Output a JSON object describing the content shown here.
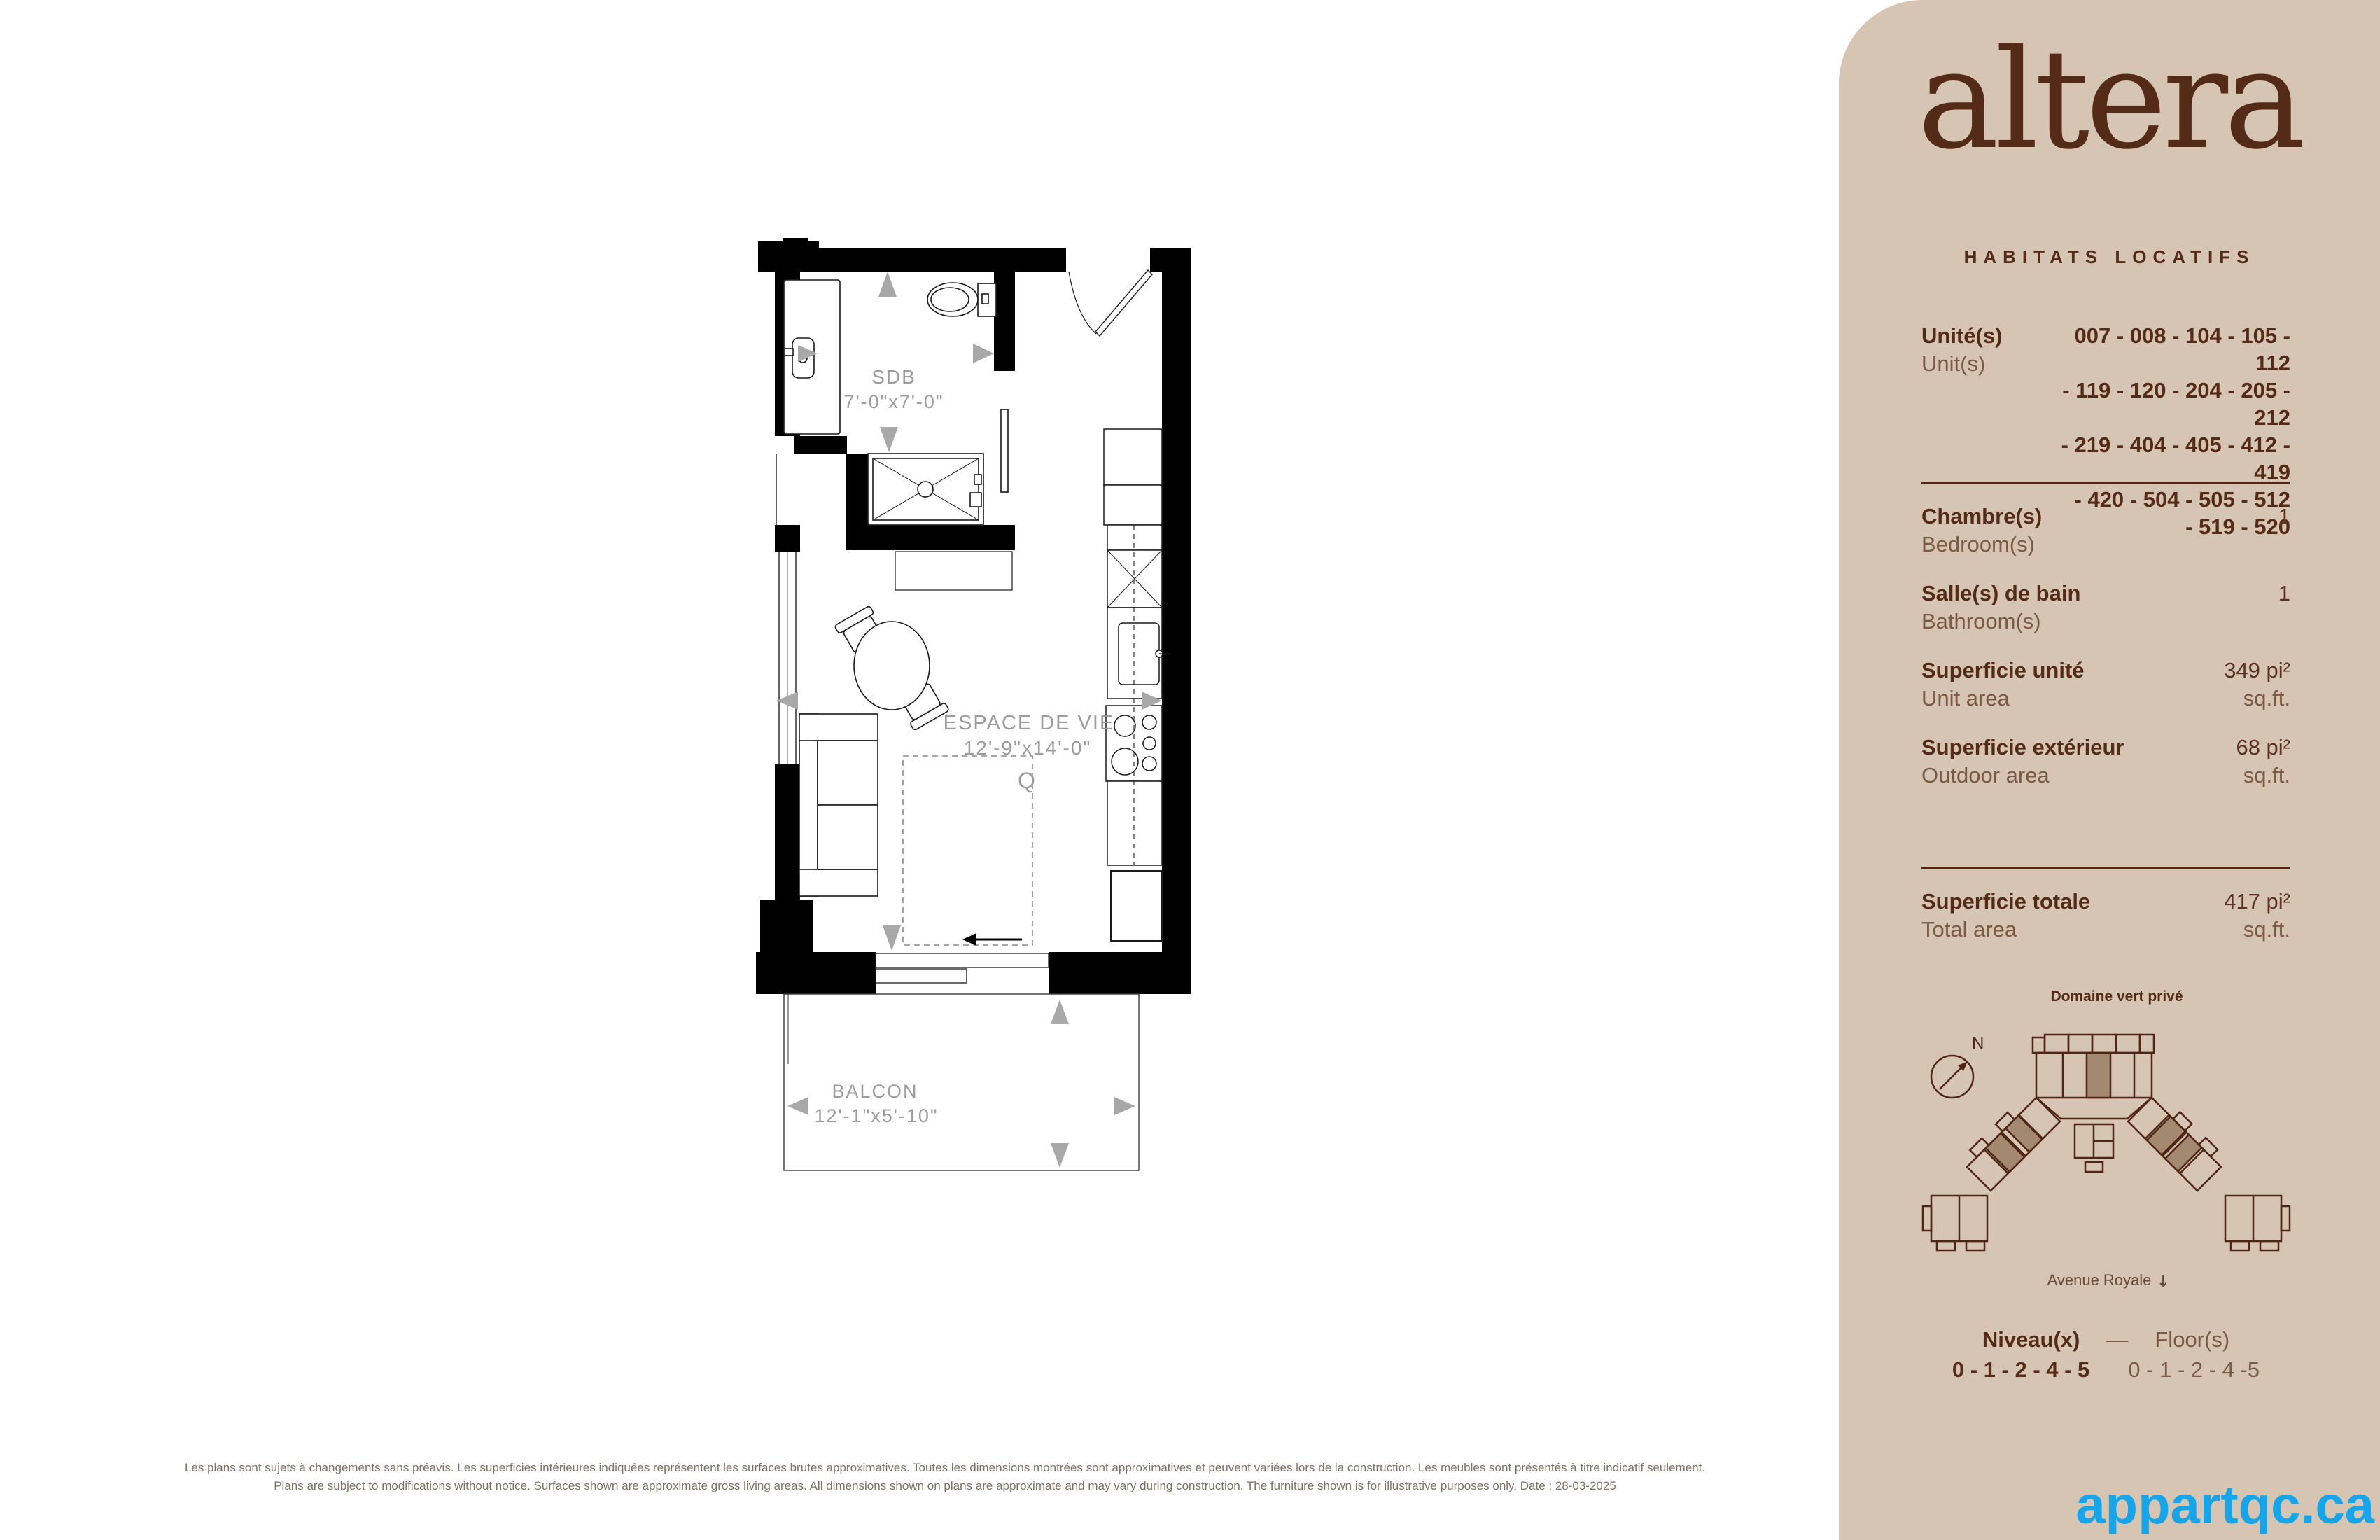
{
  "colors": {
    "sidebar_bg": "#d6c5b3",
    "brand_brown": "#542a18",
    "secondary_brown": "#7b5a45",
    "plan_label_gray": "#9c9c9c",
    "arrow_gray": "#a8a8a8",
    "site_highlight": "#a3896f",
    "watermark_blue": "#18a4e8"
  },
  "sidebar": {
    "brand": {
      "logo": "altera",
      "tagline": "HABITATS LOCATIFS"
    },
    "units": {
      "label_fr": "Unité(s)",
      "label_en": "Unit(s)",
      "lines": [
        "007 - 008 - 104 - 105 - 112",
        "- 119 - 120 - 204 - 205 - 212",
        "- 219 - 404 - 405 - 412 - 419",
        "- 420 - 504 - 505 - 512",
        "- 519 - 520"
      ]
    },
    "specs": [
      {
        "fr": "Chambre(s)",
        "en": "Bedroom(s)",
        "value": "1",
        "unit": ""
      },
      {
        "fr": "Salle(s) de bain",
        "en": "Bathroom(s)",
        "value": "1",
        "unit": ""
      },
      {
        "fr": "Superficie unité",
        "en": "Unit area",
        "value": "349 pi²",
        "unit": "sq.ft."
      },
      {
        "fr": "Superficie extérieur",
        "en": "Outdoor area",
        "value": "68 pi²",
        "unit": "sq.ft."
      }
    ],
    "total": {
      "fr": "Superficie totale",
      "en": "Total area",
      "value": "417 pi²",
      "unit": "sq.ft."
    },
    "siteplan": {
      "title": "Domaine vert privé",
      "street": "Avenue Royale",
      "compass": "N",
      "street_arrow": "↓"
    },
    "floors": {
      "label_fr": "Niveau(x)",
      "separator": "—",
      "label_en": "Floor(s)",
      "value_fr": "0 - 1 - 2 - 4 - 5",
      "value_en": "0 - 1 - 2 - 4 -5"
    }
  },
  "plan": {
    "bathroom": {
      "name": "SDB",
      "dims": "7'-0\"x7'-0\""
    },
    "living": {
      "name": "ESPACE DE VIE",
      "dims": "12'-9\"x14'-0\""
    },
    "balcony": {
      "name": "BALCON",
      "dims": "12'-1\"x5'-10\""
    },
    "bed_marker": "Q"
  },
  "footer": {
    "disclaimer_fr": "Les plans sont sujets à changements sans préavis. Les superficies intérieures indiquées représentent les surfaces brutes approximatives. Toutes les dimensions montrées sont approximatives et peuvent variées lors de la construction. Les meubles sont présentés à titre indicatif seulement.",
    "disclaimer_en": "Plans are subject to modifications without notice. Surfaces shown are approximate gross living areas. All dimensions shown on plans are approximate and may vary during construction. The furniture shown is for illustrative purposes only. Date : 28-03-2025",
    "watermark": "appartqc.ca"
  }
}
